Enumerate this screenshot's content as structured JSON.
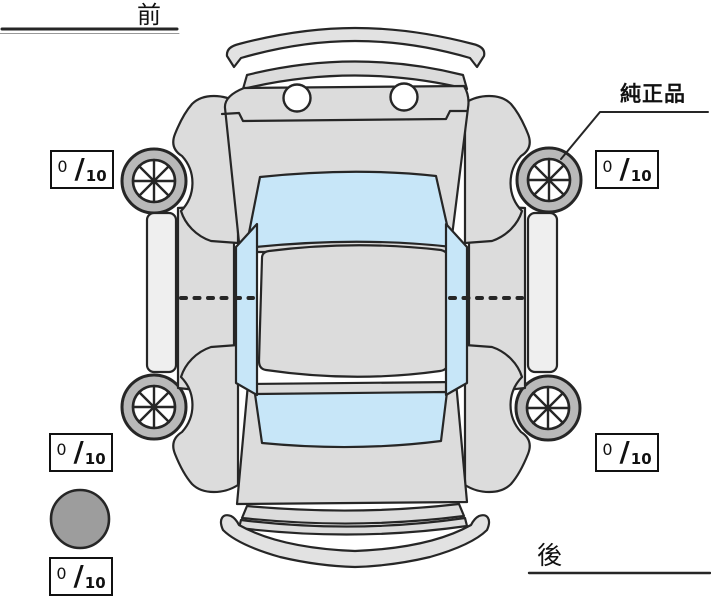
{
  "labels": {
    "front": "前",
    "rear": "後",
    "genuine_parts": "純正品"
  },
  "tread": {
    "separator": "/",
    "front_left": {
      "value": "0",
      "max": "10"
    },
    "front_right": {
      "value": "0",
      "max": "10"
    },
    "rear_left": {
      "value": "0",
      "max": "10"
    },
    "rear_right": {
      "value": "0",
      "max": "10"
    },
    "spare": {
      "value": "0",
      "max": "10"
    }
  },
  "colors": {
    "background": "#ffffff",
    "body": "#dcdcdc",
    "bumper": "#e2e2e2",
    "window_glass": "#c7e6f8",
    "tire": "#b9b9b9",
    "wheel_rim": "#ffffff",
    "spare_tire": "#9d9d9d",
    "outline": "#262626",
    "box_border": "#111111",
    "text": "#111111"
  },
  "icons": {
    "front_left_wheel": "wheel-icon",
    "front_right_wheel": "wheel-icon",
    "rear_left_wheel": "wheel-icon",
    "rear_right_wheel": "wheel-icon",
    "spare": "spare-tire-icon"
  }
}
